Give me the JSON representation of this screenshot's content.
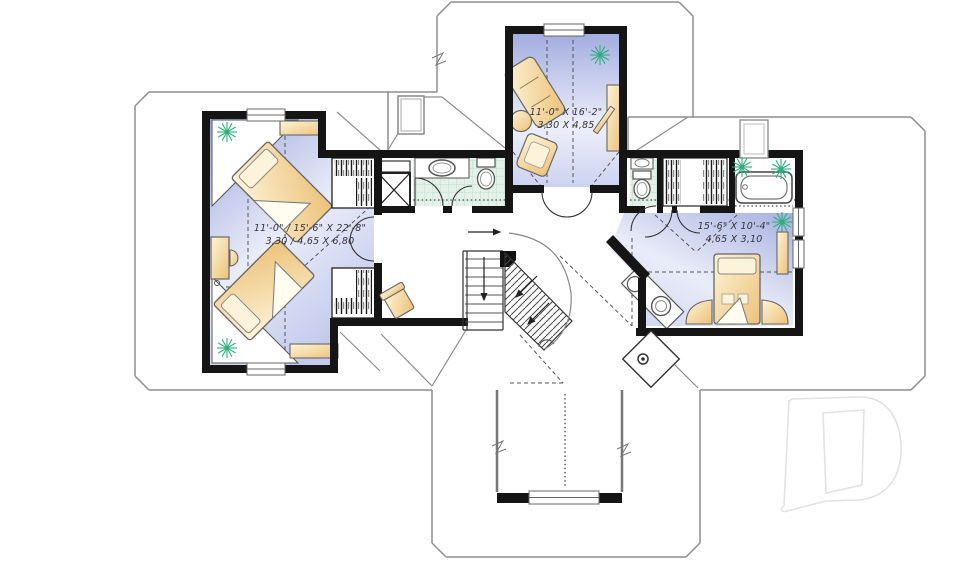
{
  "plan": {
    "rooms": [
      {
        "id": "bedroom-left",
        "imperial": "11'-0\" / 15'-6\" X 22'-8\"",
        "metric": "3,30 / 4,65 X 6,80"
      },
      {
        "id": "room-top-center",
        "imperial": "11'-0\" X 16'-2\"",
        "metric": "3,30 X 4,85"
      },
      {
        "id": "bedroom-right",
        "imperial": "15'-6\" X 10'-4\"",
        "metric": "4,65 X 3,10"
      }
    ],
    "watermark_letter": "D",
    "colors": {
      "wall": "#151515",
      "roof_line": "#8d8d8d",
      "room_fill_dark": "#a3ade0",
      "room_fill_light": "#e9ecf9",
      "tile": "#e3f1e8",
      "furniture": "#f3d9a0",
      "furniture_light": "#fcf3da",
      "plant": "#2fae7d",
      "watermark": "#e2e2e2"
    }
  }
}
